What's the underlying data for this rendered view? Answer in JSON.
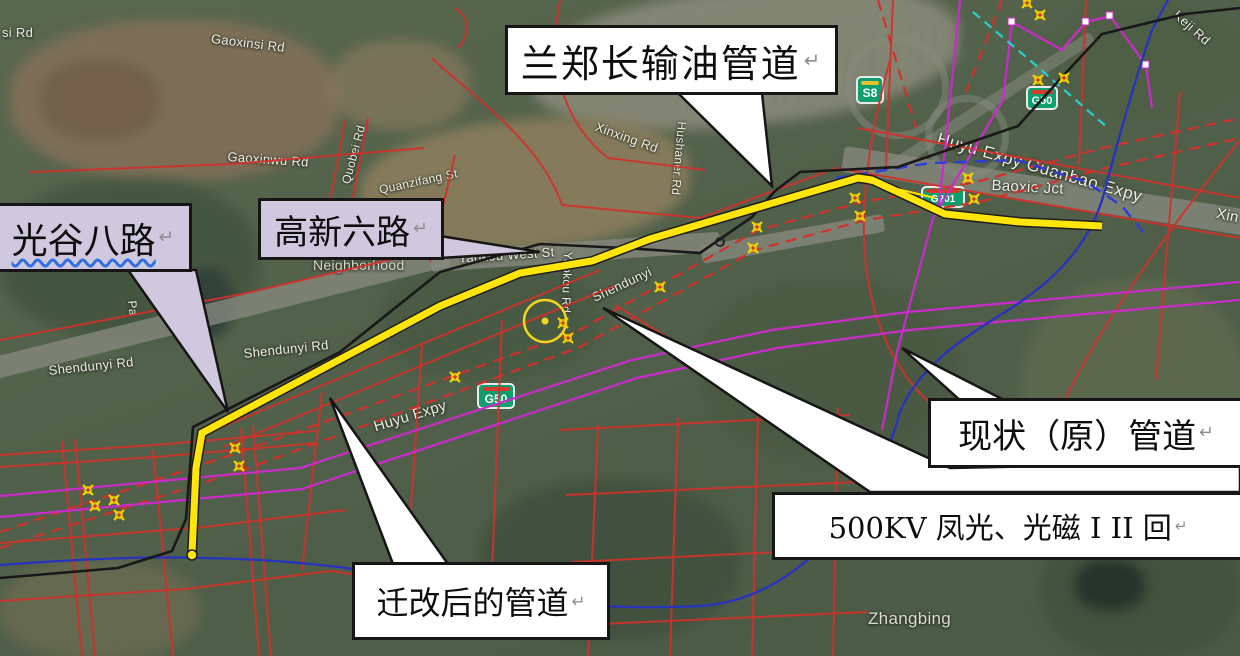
{
  "colors": {
    "relocated_pipeline_yellow": "#ffe608",
    "existing_pipeline_black": "#191919",
    "planning_road_red": "#d2312a",
    "power_500kv_red_dashed": "#d2312a",
    "corridor_magenta": "#cb2bcb",
    "river_blue": "#2733c0",
    "boundary_blue_dashed": "#2e3ed6",
    "survey_cyan_dashed": "#27d1cf",
    "callout_white": "#ffffff",
    "callout_lavender": "#cfc8df",
    "shield_green": "#0f9e6e"
  },
  "callouts": {
    "oil_pipeline": {
      "label": "兰郑长输油管道",
      "return_mark": "↵"
    },
    "guanggu_eighth_road": {
      "label": "光谷八路",
      "return_mark": "↵"
    },
    "gaoxin_sixth_road": {
      "label": "高新六路",
      "return_mark": "↵"
    },
    "existing_pipeline": {
      "label": "现状（原）管道",
      "return_mark": "↵"
    },
    "power_line_500kv": {
      "label": "500KV 凤光、光磁 I II 回",
      "return_mark": "↵"
    },
    "relocated_pipeline": {
      "label": "迁改后的管道",
      "return_mark": "↵"
    }
  },
  "road_shields": [
    {
      "code": "S8"
    },
    {
      "code": "G50"
    },
    {
      "code": "G201"
    },
    {
      "code": "G50"
    }
  ],
  "map_labels": [
    {
      "name": "si-rd-partial",
      "text": "si Rd"
    },
    {
      "name": "gaoxinsi-rd",
      "text": "Gaoxinsi Rd"
    },
    {
      "name": "gaoxinwu-rd",
      "text": "Gaoxinwu Rd"
    },
    {
      "name": "quobei-rd",
      "text": "Quobei Rd"
    },
    {
      "name": "quanzifang-st",
      "text": "Quanzifang St"
    },
    {
      "name": "xinxing-rd",
      "text": "Xinxing Rd"
    },
    {
      "name": "hushaner-rd",
      "text": "Hushaner Rd"
    },
    {
      "name": "neighborhood",
      "text": "Neighborhood"
    },
    {
      "name": "yaokou-west-st",
      "text": "Yaokou West St"
    },
    {
      "name": "yaokou-rd",
      "text": "Yaokou Rd"
    },
    {
      "name": "shendunyi",
      "text": "Shendunyi"
    },
    {
      "name": "shendunyi-rd-west",
      "text": "Shendunyi Rd"
    },
    {
      "name": "shendunyi-rd-east",
      "text": "Shendunyi Rd"
    },
    {
      "name": "pa-partial",
      "text": "Pa"
    },
    {
      "name": "huyu-expy",
      "text": "Huyu Expy"
    },
    {
      "name": "huyu-guanbao-expy",
      "text": "Huyu Expy Guanbao Expy"
    },
    {
      "name": "baoxie-jct",
      "text": "Baoxie Jct"
    },
    {
      "name": "keji-rd",
      "text": "Keji Rd"
    },
    {
      "name": "xin-partial",
      "text": "Xin"
    },
    {
      "name": "zhangbing",
      "text": "Zhangbing"
    }
  ]
}
